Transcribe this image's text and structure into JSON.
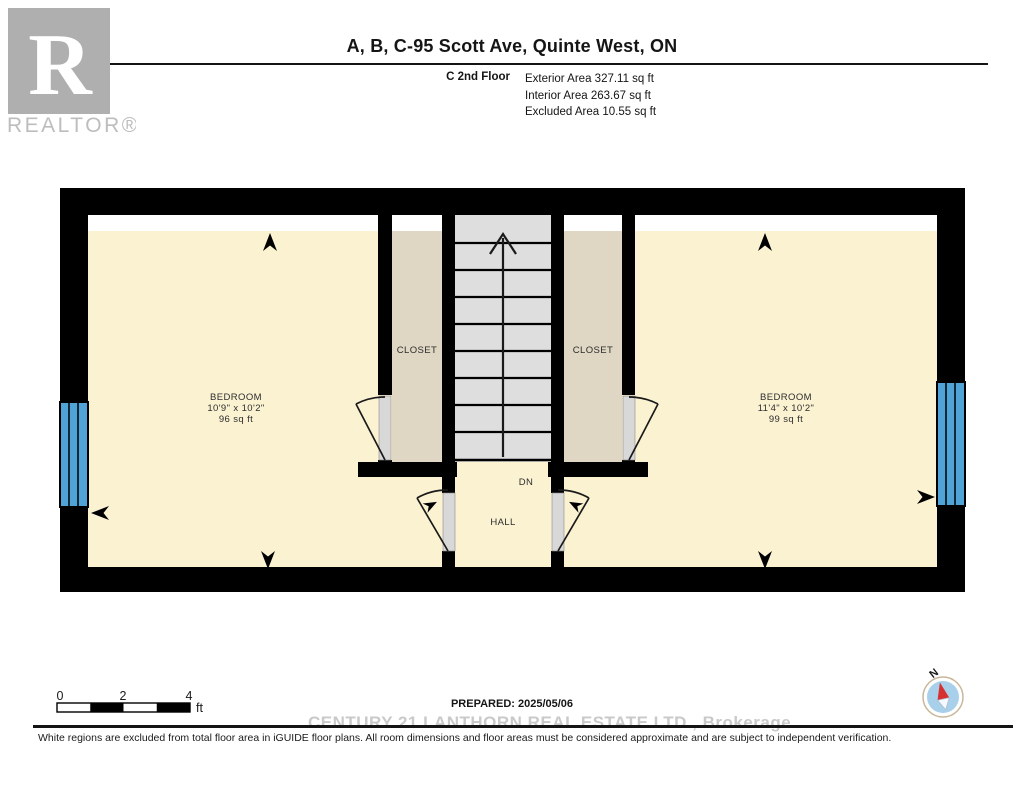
{
  "logo": {
    "letter": "R",
    "brand": "REALTOR®"
  },
  "header": {
    "title": "A, B, C-95 Scott Ave, Quinte West, ON",
    "floor_label": "C 2nd Floor",
    "area_lines": [
      "Exterior Area 327.11 sq ft",
      "Interior Area 263.67 sq ft",
      "Excluded Area 10.55 sq ft"
    ]
  },
  "plan": {
    "bedroom_left": {
      "name": "BEDROOM",
      "dims": "10'9\" x 10'2\"",
      "area": "96 sq ft"
    },
    "bedroom_right": {
      "name": "BEDROOM",
      "dims": "11'4\" x 10'2\"",
      "area": "99 sq ft"
    },
    "closet_left": "CLOSET",
    "closet_right": "CLOSET",
    "hall": "HALL",
    "stairs_down": "DN",
    "colors": {
      "room_fill": "#FBF2D2",
      "closet_fill": "#DFD6C3",
      "stairs_fill": "#DEDEDE",
      "hall_fill": "#FBF2D2",
      "excluded_fill": "#FFFFFF",
      "window_blue": "#4FA3D6",
      "wall": "#000000"
    }
  },
  "scale_bar": {
    "ticks": [
      "0",
      "2",
      "4"
    ],
    "unit": "ft"
  },
  "compass": {
    "label": "N"
  },
  "footer": {
    "prepared": "PREPARED: 2025/05/06",
    "watermark": "CENTURY 21 LANTHORN REAL ESTATE LTD., Brokerage",
    "disclaimer": "White regions are excluded from total floor area in iGUIDE floor plans. All room dimensions and floor areas must be considered approximate and are subject to independent verification."
  }
}
